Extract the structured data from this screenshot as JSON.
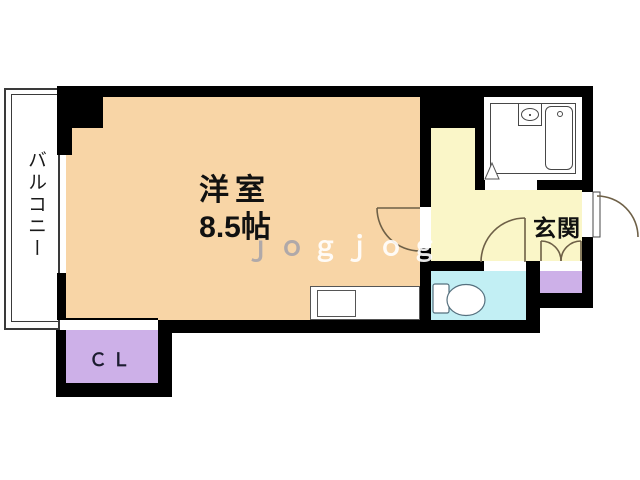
{
  "plan_type": "apartment-floor-plan",
  "rooms": [
    {
      "name": "western-room",
      "label": "洋室",
      "size": "8.5帖",
      "color": "#F8D5A6"
    },
    {
      "name": "balcony",
      "label": "バルコニー",
      "color": "#FFFFFF"
    },
    {
      "name": "entrance",
      "label": "玄関",
      "color": "#FAF6C8"
    },
    {
      "name": "closet",
      "label": "ＣＬ",
      "color": "#CDB0E8"
    },
    {
      "name": "toilet-room",
      "label": "",
      "color": "#C2EFF4"
    },
    {
      "name": "shoe-cabinet",
      "label": "",
      "color": "#CDB0E8"
    },
    {
      "name": "bathroom-unit",
      "label": "",
      "color": "#FFFFFF"
    }
  ],
  "watermark": {
    "part1": "ｊｏ",
    "part2": "ｇｊｏｇ"
  },
  "colors": {
    "wall": "#000000",
    "door_arc": "#6e6047",
    "fixture_outline": "#55707e",
    "counter_outline": "#555555"
  },
  "icons": {
    "bathtub-icon": "rounded rectangle with faucet dot",
    "sink-icon": "oval basin in box",
    "toilet-icon": "tank + bowl shape",
    "kitchen-counter": "counter with sink rectangle",
    "door-swing-arc": "quarter-circle swing lines"
  }
}
